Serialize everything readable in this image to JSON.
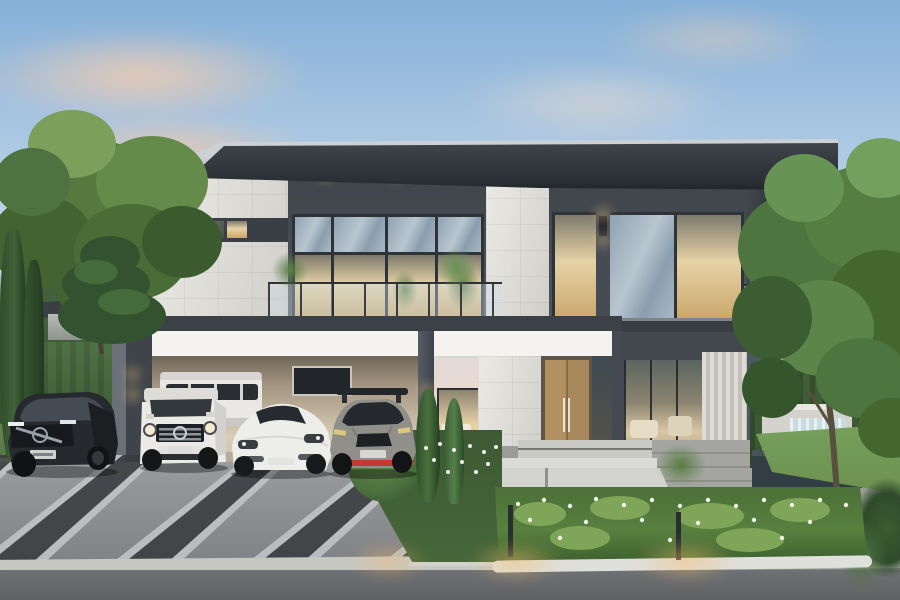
{
  "scene": {
    "description": "Dusk 3D architectural rendering of a modern two-storey luxury house with white marble and dark grey panel facade, four cars parked under a left-side carport, landscaped entrance walkway with flower beds, a stone waterfall water feature on the right, framed by mature trees under a peach-cloud sky",
    "time_of_day": "dusk",
    "style": "photorealistic exterior render"
  },
  "palette": {
    "sky_top": "#85b0d8",
    "sky_mid": "#c3d8ea",
    "sky_horizon": "#ead9cf",
    "cloud_warm": "#f4cdb0",
    "roof_dark": "#363b41",
    "roof_edge": "#ccd1d5",
    "cladding_dark": "#50565e",
    "cladding_darker": "#3f444b",
    "marble_light": "#eceae5",
    "marble_shadow": "#cfcec9",
    "fascia_white": "#f4f3ef",
    "glass_cool": "#9badbb",
    "glass_dark": "#3e4a52",
    "interior_warm": "#e6d2a6",
    "interior_deep": "#caa76a",
    "wood_door": "#b08f62",
    "drive_gray": "#94959a",
    "stripe_dark": "#3a3d40",
    "stripe_light": "#c2c5c7",
    "road_dark": "#6f7174",
    "curb_light": "#c6c7c3",
    "lawn_green": "#6d9050",
    "shrub_green": "#4a6e3e",
    "tree_green": "#55793f",
    "tree_dark": "#34532c",
    "hedge_dark": "#3a5633",
    "flower_white": "#eef2e8",
    "water_stone": "#c9c9c3",
    "water_dark": "#323e44",
    "light_glow": "#f6c97e",
    "car_dark_suv": "#26292d",
    "car_van": "#e9e8e4",
    "car_gwagon": "#ebeae6",
    "car_taycan": "#edeeea",
    "car_gtr": "#908f8a",
    "car_gtr_accent": "#c23b2e"
  },
  "house": {
    "storeys": 2,
    "roof": "flat dark overhanging slab roof with thin light metal edge",
    "materials": [
      "white marble tile",
      "dark grey panel cladding",
      "full-height glazing",
      "timber double entry door",
      "fluted white slat wall"
    ],
    "features": [
      "glass balustrade balcony with planters",
      "recessed soffit downlights",
      "up-down wall sconces",
      "clerestory window band on marble volume",
      "carport with white fascia beam"
    ]
  },
  "vehicles": [
    {
      "id": "dark-suv",
      "label": "black luxury SUV with chrome grille and lit plate",
      "body_color": "#26292d"
    },
    {
      "id": "white-van",
      "label": "white passenger van parked behind",
      "body_color": "#e9e8e4"
    },
    {
      "id": "white-boxy-suv",
      "label": "white boxy off-road SUV with round headlights",
      "body_color": "#ebeae6"
    },
    {
      "id": "white-sports-sedan",
      "label": "white electric sports sedan",
      "body_color": "#edeeea"
    },
    {
      "id": "grey-sports-coupe",
      "label": "gunmetal sports coupe with red front lip and rear wing",
      "body_color": "#908f8a",
      "accent_color": "#c23b2e"
    }
  ],
  "landscape": {
    "elements": [
      "diagonal striped concrete driveway",
      "light paver walkway",
      "entrance steps",
      "flower beds with white blossoms",
      "columnar cypresses",
      "clipped round shrub",
      "stone waterfall feature with pool",
      "tall hedge wall",
      "mature leafy trees",
      "warm bollard path lights",
      "distant neighbour houses"
    ]
  },
  "lighting": {
    "sky": "clear dusk sky with warm peach clouds",
    "artificial": [
      "warm interior glow in windows",
      "soffit downlights",
      "wall sconces on pillars",
      "bollard lights on walkway"
    ]
  }
}
